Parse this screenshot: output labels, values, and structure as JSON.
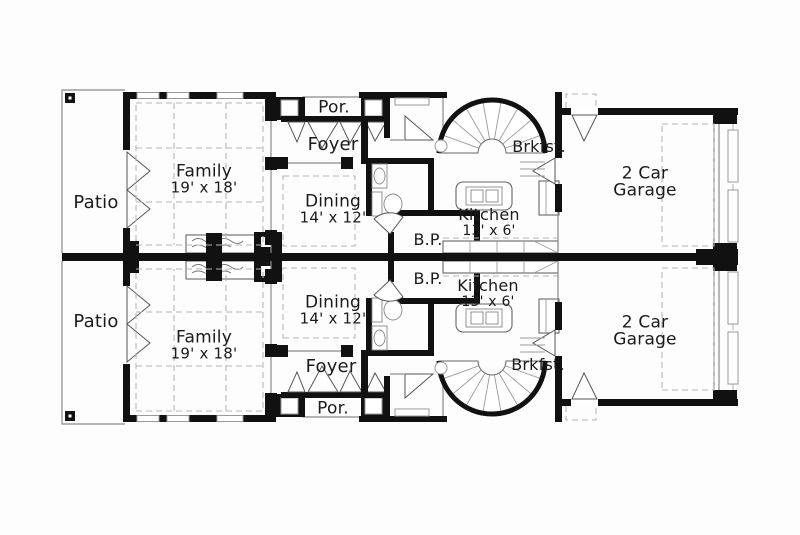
{
  "figure": {
    "kind": "duplex-floor-plan"
  },
  "colors": {
    "wall": "#111111",
    "line": "#8a8a8a",
    "dash": "#b5b5b5",
    "text": "#1a1a1a",
    "bg": "#fdfdfd"
  },
  "rooms": {
    "patio": "Patio",
    "family": "Family",
    "family_dim": "19' x 18'",
    "porch": "Por.",
    "foyer": "Foyer",
    "dining": "Dining",
    "dining_dim": "14' x 12'",
    "butlers_pantry": "B.P.",
    "kitchen": "Kitchen",
    "kitchen_dim": "13' x 6'",
    "breakfast": "Brkfst.",
    "garage_line1": "2 Car",
    "garage_line2": "Garage"
  }
}
